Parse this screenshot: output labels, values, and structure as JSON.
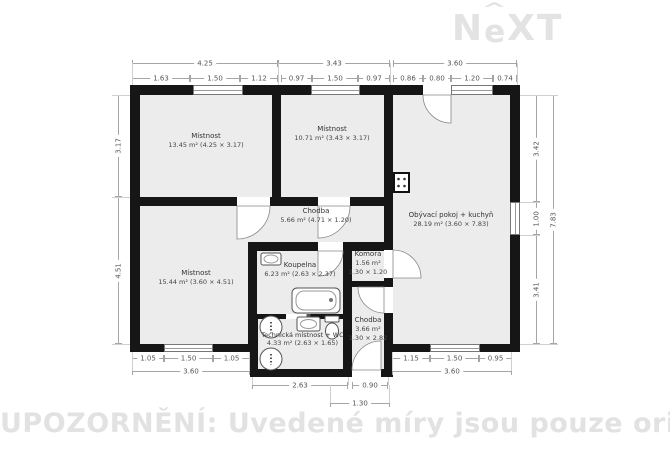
{
  "logo": {
    "part1": "N",
    "part2": "e",
    "part3": "XT",
    "caret": "^"
  },
  "watermark": "UPOZORNĚNÍ: Uvedené míry jsou pouze orientační",
  "rooms": {
    "r1": {
      "name": "Místnost",
      "detail": "13.45 m² (4.25 × 3.17)"
    },
    "r2": {
      "name": "Místnost",
      "detail": "10.71 m² (3.43 × 3.17)"
    },
    "living": {
      "name": "Obývací pokoj + kuchyň",
      "detail": "28.19 m² (3.60 × 7.83)"
    },
    "hall": {
      "name": "Chodba",
      "detail": "5.66 m² (4.71 × 1.20)"
    },
    "r4": {
      "name": "Místnost",
      "detail": "15.44 m² (3.60 × 4.51)"
    },
    "bath": {
      "name": "Koupelna",
      "detail": "6.23 m² (2.63 × 2.37)"
    },
    "pantry": {
      "name": "Komora",
      "area": "1.56 m²",
      "size": "1.30 × 1.20"
    },
    "tech": {
      "name": "Technická místnost + WC",
      "detail": "4.33 m² (2.63 × 1.65)"
    },
    "hall2": {
      "name": "Chodba",
      "area": "3.66 m²",
      "size": "1.30 × 2.82"
    }
  },
  "dims": {
    "top_totals": [
      "4.25",
      "3.43",
      "3.60"
    ],
    "top_subs": [
      "1.63",
      "1.50",
      "1.12",
      "0.97",
      "1.50",
      "0.97",
      "0.86",
      "0.80",
      "1.20",
      "0.74"
    ],
    "left": [
      "3.17",
      "4.51"
    ],
    "right": [
      "3.42",
      "1.00",
      "3.41",
      "7.83"
    ],
    "bottom_left": [
      "1.05",
      "1.50",
      "1.05",
      "3.60"
    ],
    "bottom_right": [
      "1.15",
      "1.50",
      "0.95",
      "3.60"
    ],
    "bottom_center": [
      "2.63",
      "0.90",
      "1.30"
    ]
  }
}
